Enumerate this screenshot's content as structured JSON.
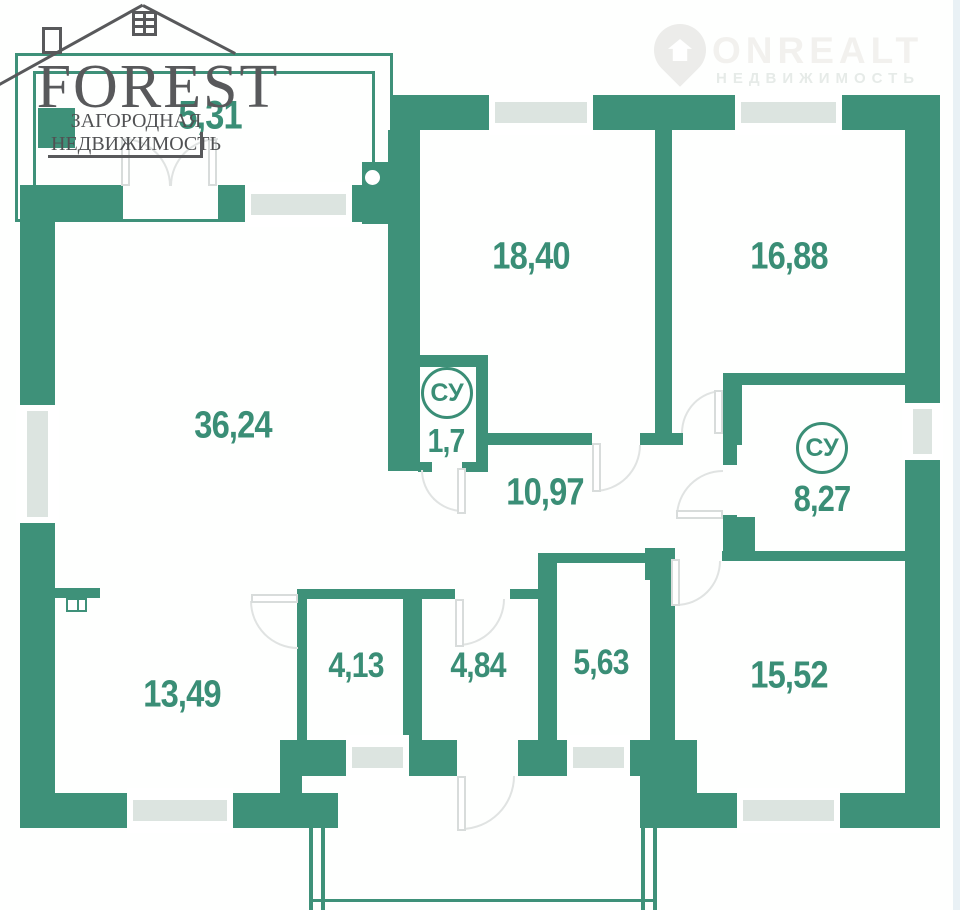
{
  "brand_logo": {
    "title": "FOREST",
    "subtitle": "ЗАГОРОДНАЯ НЕДВИЖИМОСТЬ"
  },
  "watermark": {
    "title": "ONREALT",
    "subtitle": "НЕДВИЖИМОСТЬ"
  },
  "floor_plan": {
    "rooms": {
      "porch": {
        "area": "5,31"
      },
      "living": {
        "area": "36,24"
      },
      "bedroom_top_left": {
        "area": "18,40"
      },
      "bedroom_top_right": {
        "area": "16,88"
      },
      "wc_small": {
        "label": "СУ",
        "area": "1,7"
      },
      "hallway": {
        "area": "10,97"
      },
      "wc_large": {
        "label": "СУ",
        "area": "8,27"
      },
      "room_bottom_left": {
        "area": "13,49"
      },
      "small_room_1": {
        "area": "4,13"
      },
      "entry_hall": {
        "area": "4,84"
      },
      "small_room_2": {
        "area": "5,63"
      },
      "bedroom_bottom_right": {
        "area": "15,52"
      }
    },
    "colors": {
      "wall": "#3E9179",
      "window_glass": "#DCE4E0",
      "room_label": "#3A8E76",
      "logo_text": "#58595B",
      "watermark_text": "#F2F1EE"
    }
  }
}
